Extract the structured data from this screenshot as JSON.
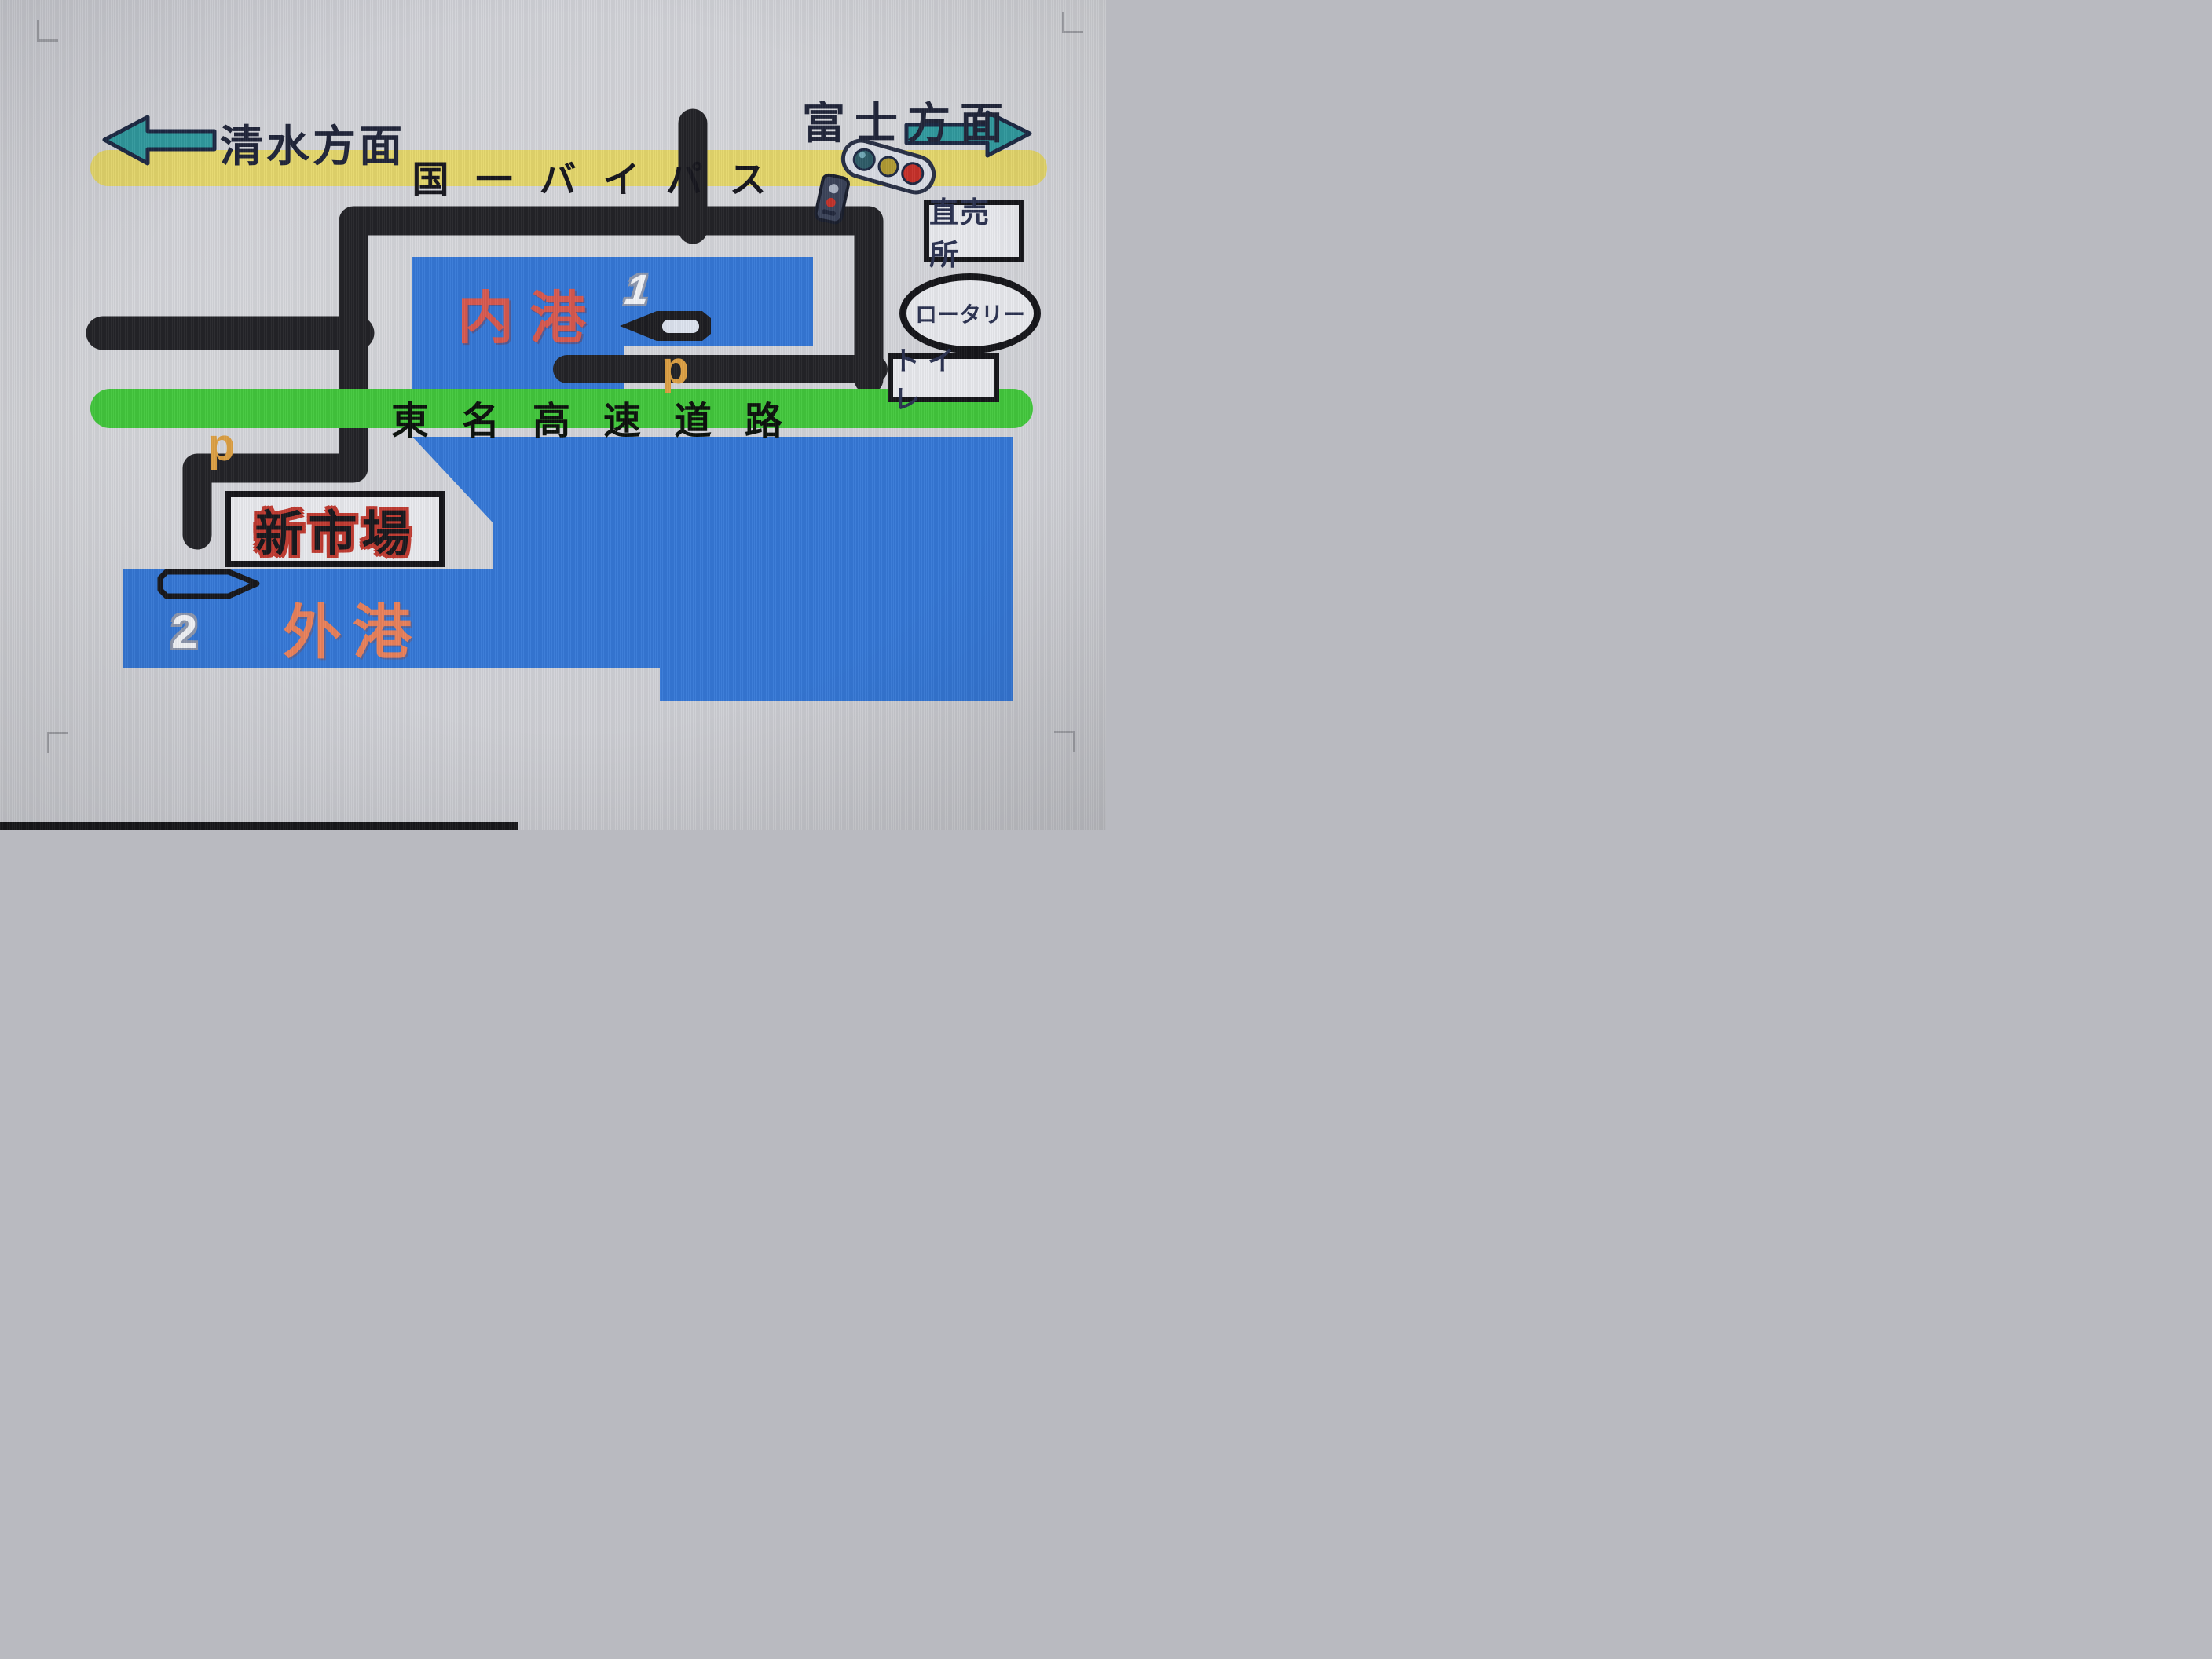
{
  "directions": {
    "west": "清水方面",
    "east": "富士方面"
  },
  "roads": {
    "bypass": "国一バイパス",
    "expressway": "東名高速道路"
  },
  "harbors": {
    "inner": "内港",
    "outer": "外港"
  },
  "facilities": {
    "direct_sales": "直売所",
    "rotary": "ロータリー",
    "toilet": "トイレ",
    "new_market": "新市場"
  },
  "markers": {
    "pier_1": "1",
    "pier_2": "2",
    "parking_upper": "p",
    "parking_lower": "p"
  },
  "colors": {
    "water": "#3477d6",
    "bypass_road": "#e5d76b",
    "expressway_road": "#41c73b",
    "road": "#222226",
    "direction_arrow": "#2f9a9e",
    "inner_harbor_text": "#d7584e",
    "outer_harbor_text": "#e9805a",
    "parking_text": "#dc9f42",
    "market_text_glow": "#c03a30",
    "signal_red": "#c62f28",
    "signal_yellow": "#b09a32",
    "signal_blue": "#2c5a66"
  }
}
